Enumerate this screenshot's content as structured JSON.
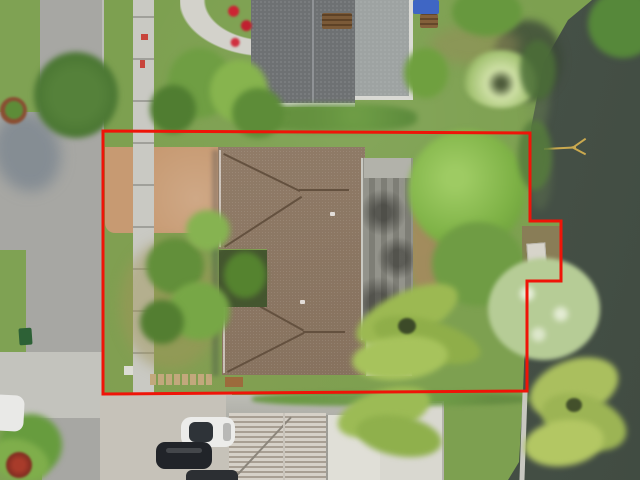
{
  "meta": {
    "image_type": "aerial-drone-photograph",
    "description": "Top-down aerial photo of a waterfront single-family home lot outlined with a red property-boundary overlay; street and sidewalk on the left, neighboring houses above and below, lake on the right"
  },
  "boundary": {
    "color": "#ef1408",
    "stroke_width": "3",
    "points_attr": "103,131 530,133 530,221 561,221 561,281 527,281 527,391 103,394",
    "shape": "rectangular parcel with a dock bump-out on the right (water) side"
  },
  "palette": {
    "grass": "#7da050",
    "dry_grass": "#9e9b63",
    "water": "#49544a",
    "street": "#a7a7a3",
    "sidewalk": "#c9c9c3",
    "sand_driveway": "#c79a72",
    "brown_shingle_roof": "#8d7660",
    "weathered_plank_roof": "#85857d",
    "neighbor_gravel_roof": "#6e7173",
    "white_roof": "#dbdad2",
    "boundary_red": "#ef1408"
  },
  "objects": [
    "red-property-boundary",
    "main-house-brown-hip-roof",
    "weathered-gray-plank-roof-section",
    "white-roof-section",
    "interior-courtyard-with-palms",
    "sand-dirt-front-driveway",
    "public-sidewalk",
    "street",
    "neighbor-house-gravel-roof",
    "curved-front-walkway",
    "blue-tarp",
    "garden-bench",
    "red-flower-bed",
    "lake-water",
    "boat-dock",
    "seawall",
    "fallen-branch-in-water",
    "backyard-trees",
    "waterfront-palm-trees",
    "front-yard-palms",
    "bottom-house-tile-roof",
    "bottom-white-building",
    "concrete-driveway",
    "white-car-on-street",
    "white-suv-in-driveway",
    "black-car-in-driveway",
    "car-at-bottom-edge",
    "green-trash-bin",
    "paver-path",
    "street-tree",
    "tree-shadow-on-street",
    "red-plant",
    "mulch-ring-tree"
  ]
}
